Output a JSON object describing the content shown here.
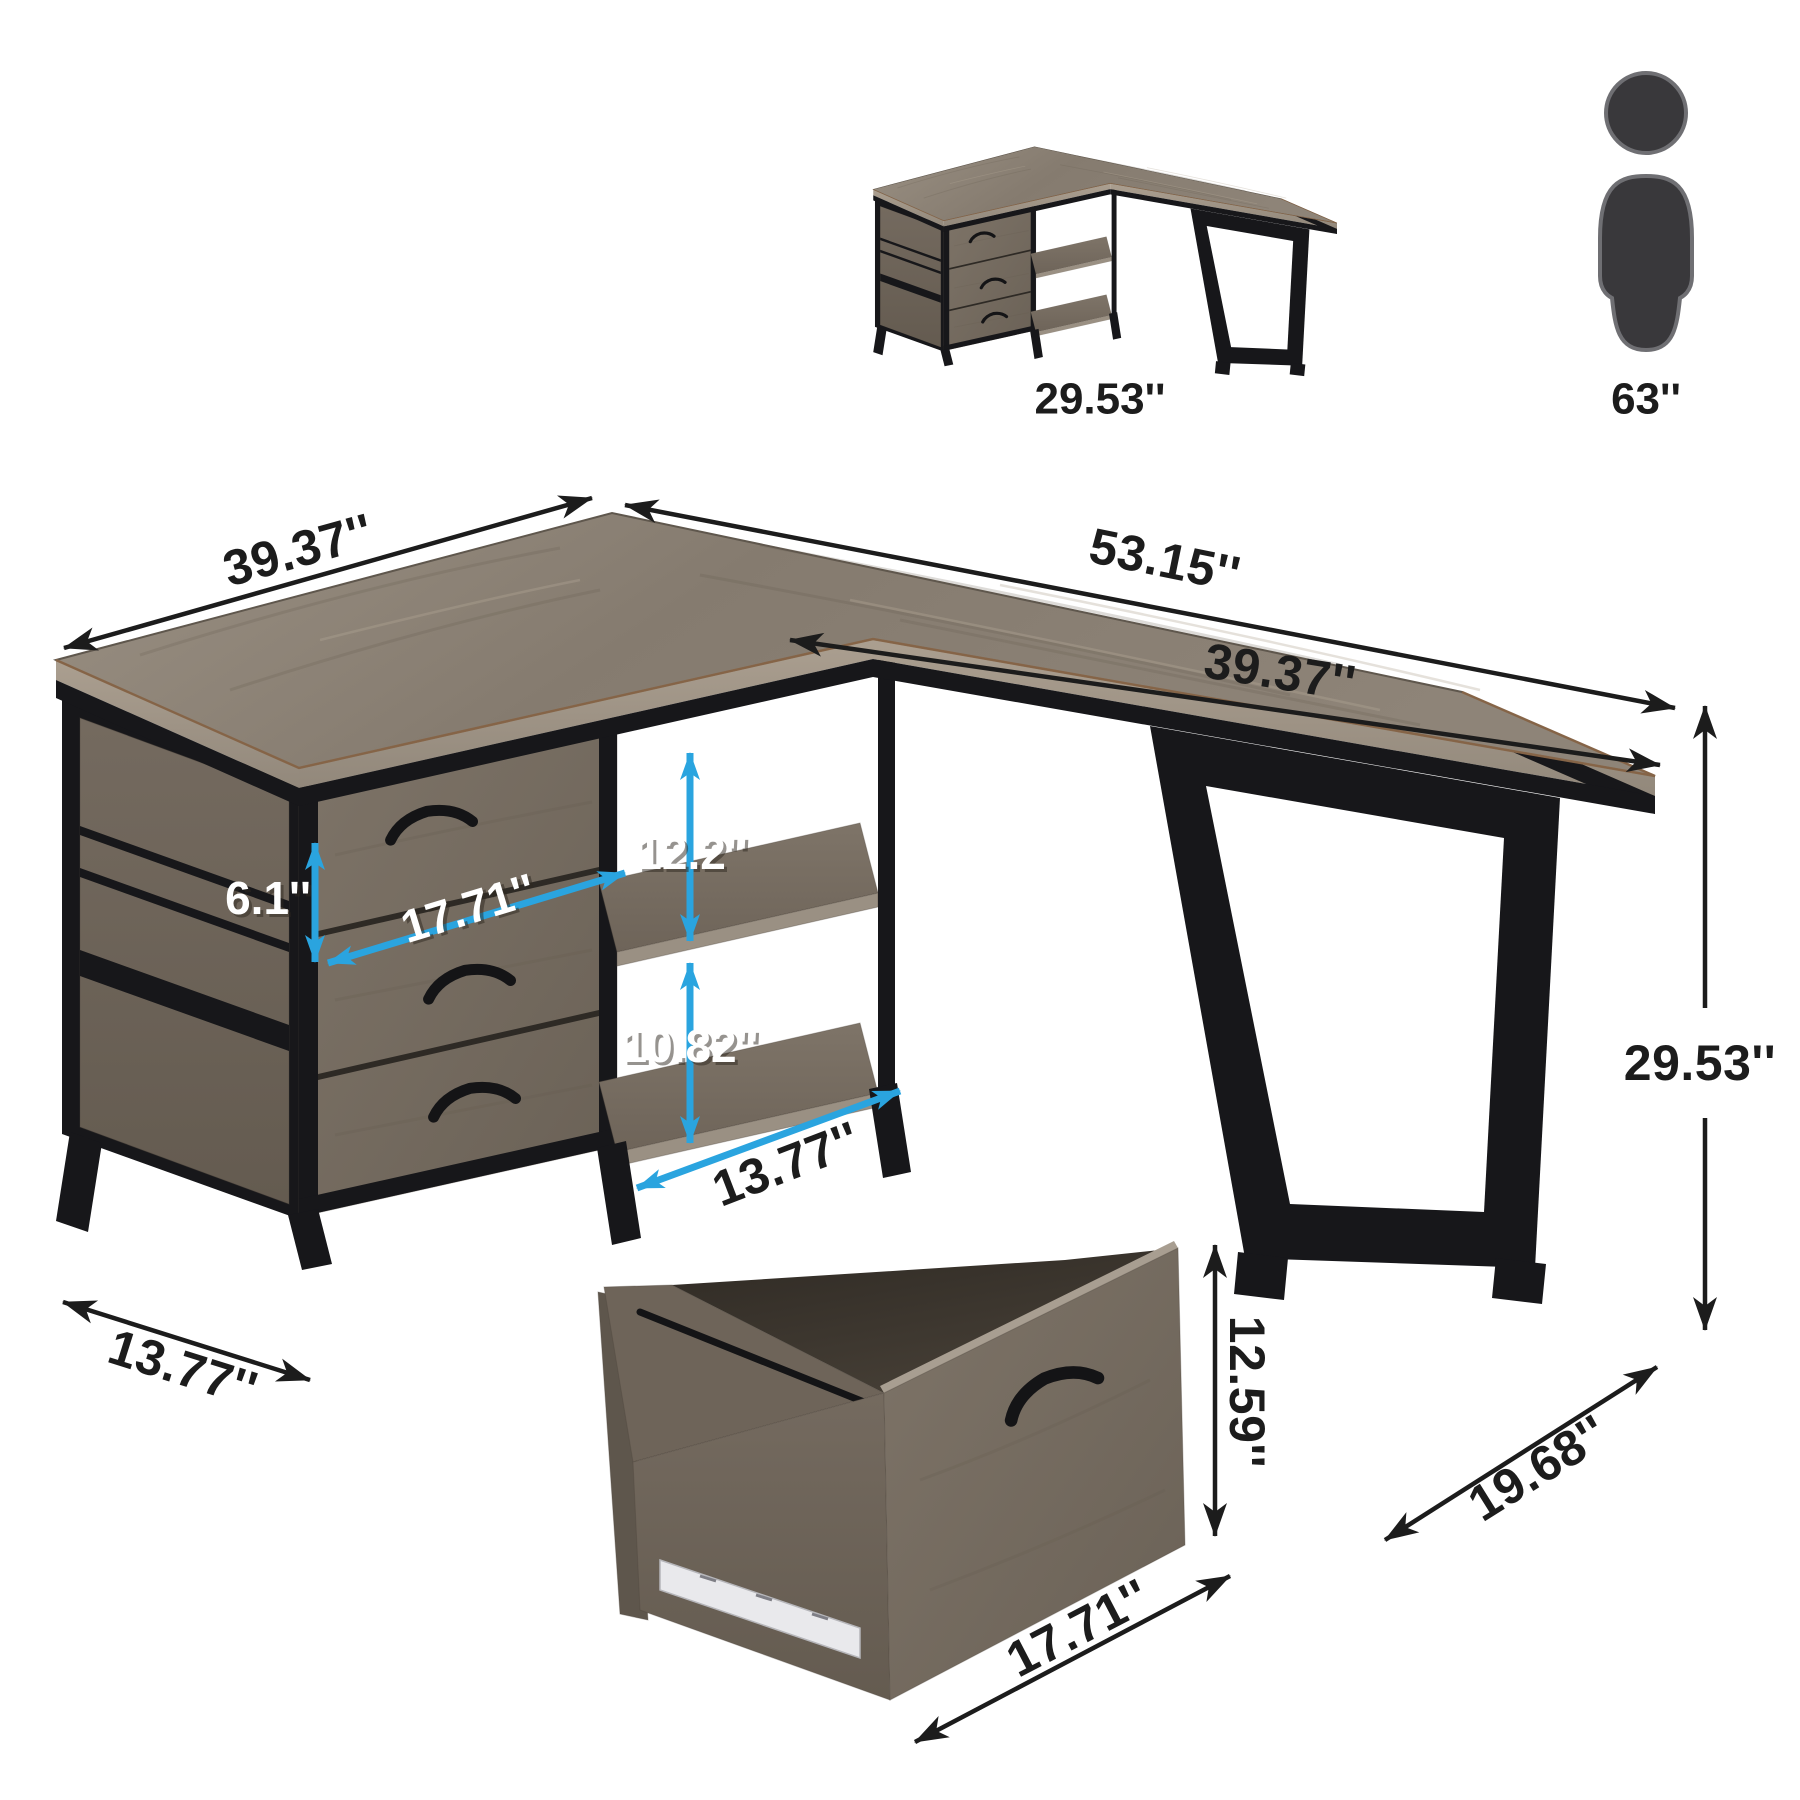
{
  "page": {
    "background": "#ffffff",
    "type": "product-dimension-diagram",
    "product": "l-shaped-desk-with-file-drawers-and-shelves"
  },
  "reference": {
    "desk_height_label": "29.53''",
    "person_height_label": "63''"
  },
  "dimensions": {
    "left_wing_length": "39.37''",
    "total_length": "53.15''",
    "right_wing_length": "39.37''",
    "desk_height": "29.53''",
    "top_drawer_front_height": "6.1''",
    "drawer_opening_width": "17.71''",
    "upper_shelf_clearance": "12.2''",
    "lower_shelf_clearance": "10.82''",
    "shelf_depth": "13.77''",
    "cabinet_floor_depth": "13.77''",
    "leg_depth": "19.68''",
    "file_drawer_height": "12.59''",
    "file_drawer_width": "17.71''"
  },
  "colors": {
    "dimension_blue": "#2AA4DF",
    "dimension_black": "#1C1C1C",
    "metal_black": "#17171A",
    "wood_top": "#8D8378",
    "wood_front": "#776D62",
    "white_label": "#FFFFFF"
  },
  "icons": {
    "person_icon": "standing-person-silhouette"
  }
}
